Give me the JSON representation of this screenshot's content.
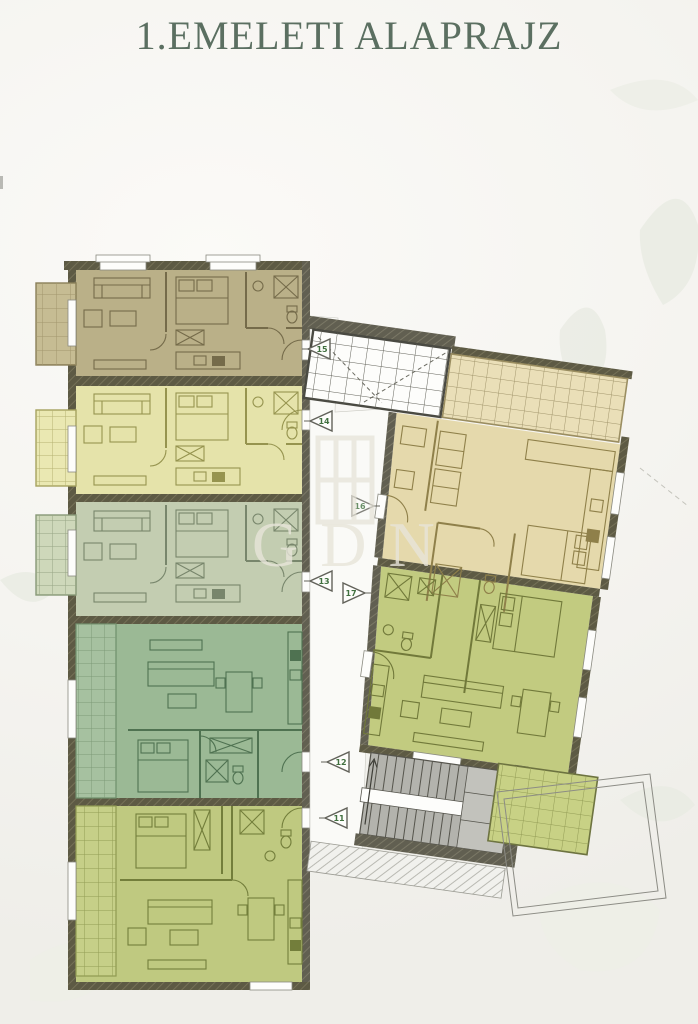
{
  "page": {
    "title": "1.EMELETI ALAPRAJZ",
    "title_color": "#5b6f61",
    "background_color": "#f5f4f0"
  },
  "watermark": {
    "text": "GDN"
  },
  "floorplan": {
    "name": "first-floor-plan",
    "corridor_markers": [
      {
        "label": "15"
      },
      {
        "label": "14"
      },
      {
        "label": "16"
      },
      {
        "label": "13"
      },
      {
        "label": "17"
      },
      {
        "label": "12"
      },
      {
        "label": "11"
      }
    ],
    "units": [
      {
        "number": "15",
        "color": "#bab088",
        "position": "left-column-top"
      },
      {
        "number": "14",
        "color": "#e5e3aa",
        "position": "left-column-second"
      },
      {
        "number": "13",
        "color": "#c3cdb1",
        "position": "left-column-third"
      },
      {
        "number": "12",
        "color": "#9bb995",
        "position": "left-column-fourth"
      },
      {
        "number": "11",
        "color": "#bfc980",
        "position": "left-column-bottom"
      },
      {
        "number": "16",
        "color": "#e5d9ac",
        "position": "right-wing-top"
      },
      {
        "number": "17",
        "color": "#c2cb80",
        "position": "right-wing-bottom"
      }
    ]
  }
}
